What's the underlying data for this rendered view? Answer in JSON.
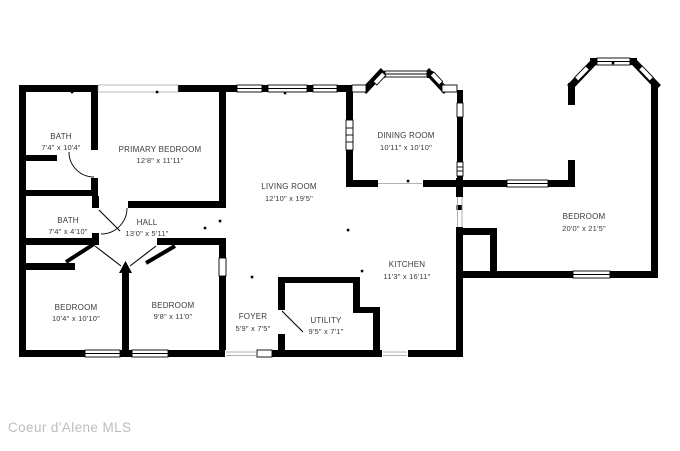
{
  "watermark": "Coeur d'Alene MLS",
  "colors": {
    "wall": "#000000",
    "label": "#3a3a3a",
    "watermark": "#bdbdbd",
    "bg": "#ffffff"
  },
  "rooms": [
    {
      "name": "BATH",
      "dims": "7'4\" x 10'4\""
    },
    {
      "name": "PRIMARY BEDROOM",
      "dims": "12'8\" x 11'11\""
    },
    {
      "name": "BATH",
      "dims": "7'4\" x 4'10\""
    },
    {
      "name": "HALL",
      "dims": "13'0\" x 5'11\""
    },
    {
      "name": "LIVING ROOM",
      "dims": "12'10\" x 19'5\""
    },
    {
      "name": "DINING ROOM",
      "dims": "10'11\" x 10'10\""
    },
    {
      "name": "KITCHEN",
      "dims": "11'3\" x 16'11\""
    },
    {
      "name": "BEDROOM",
      "dims": "20'0\" x 21'5\""
    },
    {
      "name": "BEDROOM",
      "dims": "10'4\" x 10'10\""
    },
    {
      "name": "BEDROOM",
      "dims": "9'8\" x 11'0\""
    },
    {
      "name": "FOYER",
      "dims": "5'9\" x 7'5\""
    },
    {
      "name": "UTILITY",
      "dims": "9'5\" x 7'1\""
    }
  ]
}
